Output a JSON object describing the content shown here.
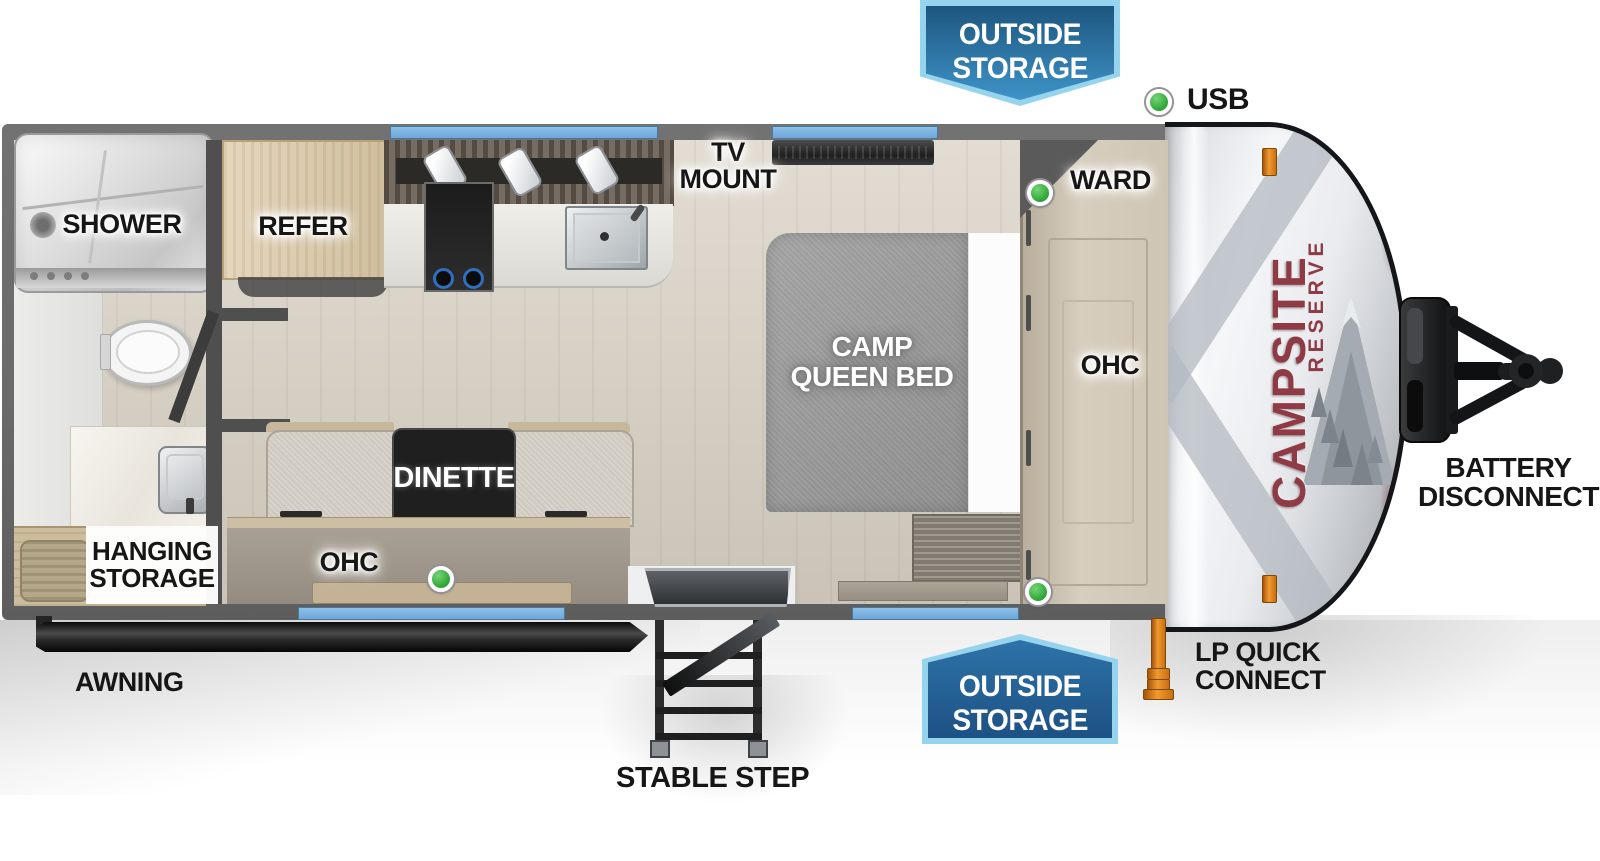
{
  "legend": {
    "usb_label": "USB"
  },
  "banner_top": {
    "line1": "OUTSIDE",
    "line2": "STORAGE"
  },
  "banner_bottom": {
    "line1": "OUTSIDE",
    "line2": "STORAGE"
  },
  "labels": {
    "shower": "SHOWER",
    "refer": "REFER",
    "tv_mount_line1": "TV",
    "tv_mount_line2": "MOUNT",
    "ward": "WARD",
    "bed_line1": "CAMP",
    "bed_line2": "QUEEN BED",
    "ohc_bedroom": "OHC",
    "dinette": "DINETTE",
    "ohc_dinette": "OHC",
    "hanging_line1": "HANGING",
    "hanging_line2": "STORAGE",
    "awning": "AWNING",
    "stable_step": "STABLE STEP",
    "lp_line1": "LP QUICK",
    "lp_line2": "CONNECT",
    "battery_line1": "BATTERY",
    "battery_line2": "DISCONNECT"
  },
  "branding": {
    "model": "CAMPSITE",
    "series": "RESERVE"
  },
  "colors": {
    "banner_border": "#96d4ee",
    "banner_fill_dark": "#1d567f",
    "banner_fill_light": "#3e93c8",
    "window_blue": "#6ea6d9",
    "indicator_green": "#33a73a",
    "brand_red": "#8e3b45",
    "wall_gray": "#696969",
    "clearance_orange": "#f09a2e"
  }
}
